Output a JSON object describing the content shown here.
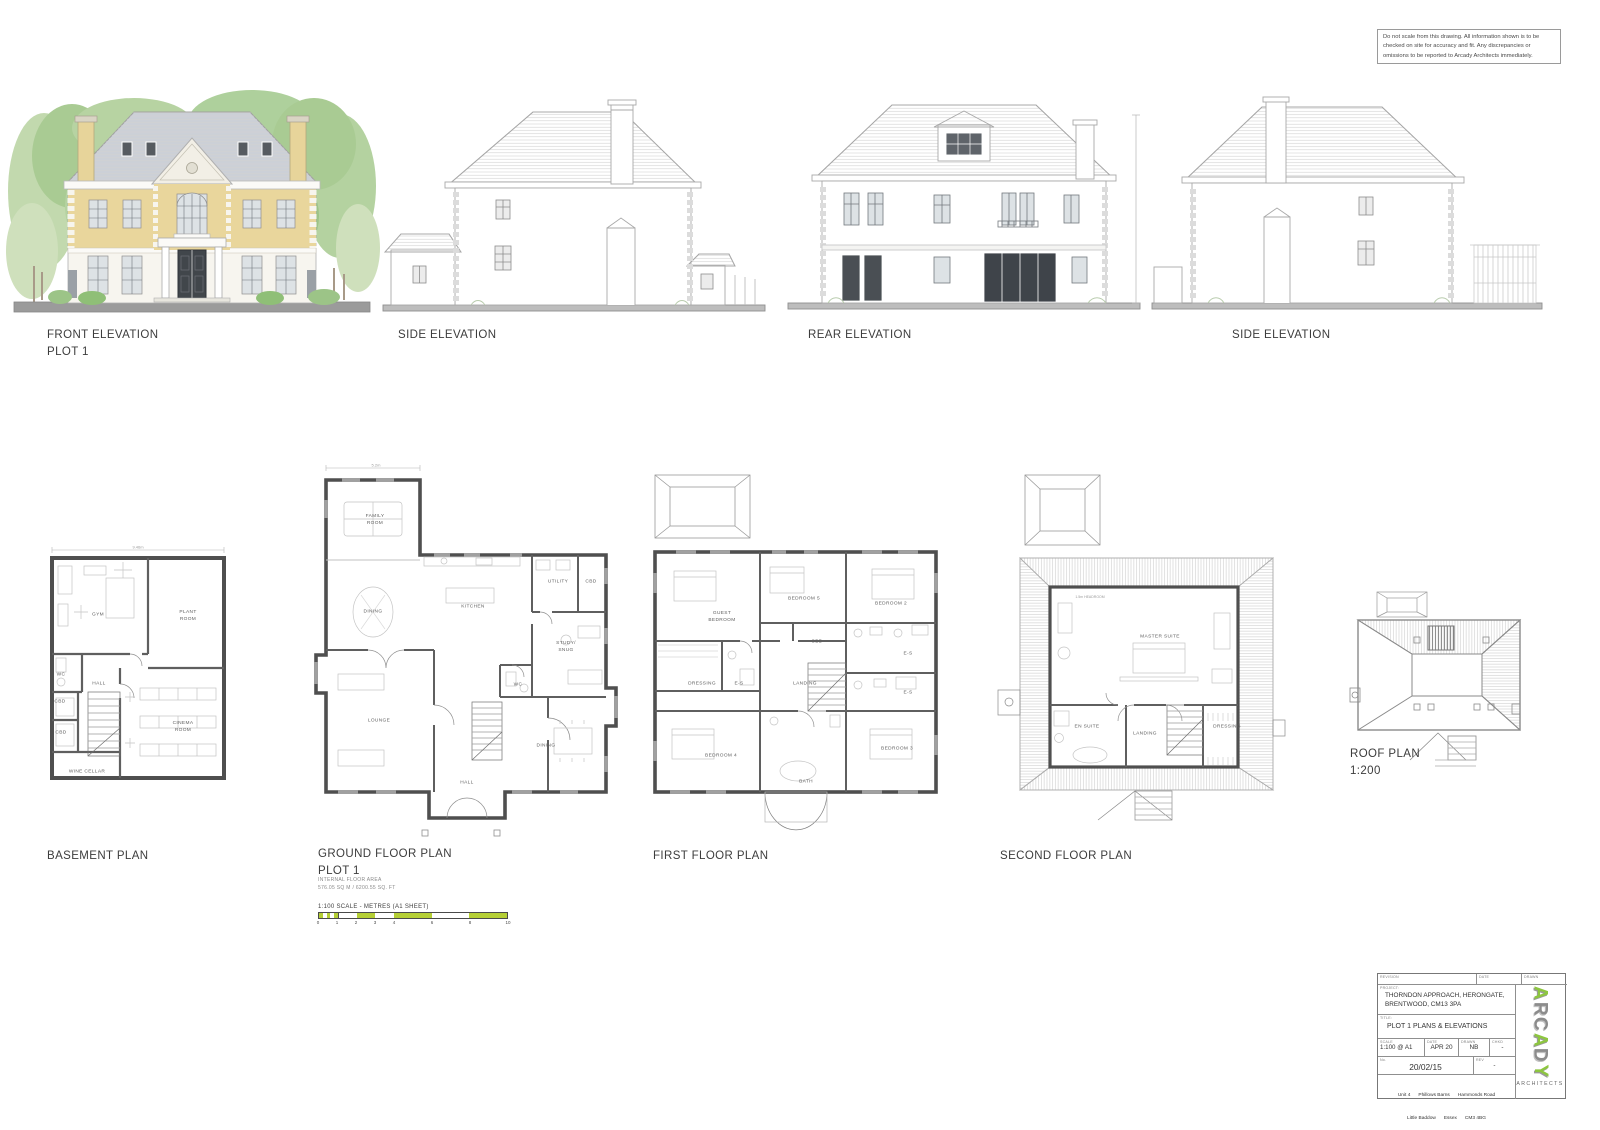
{
  "disclaimer": "Do not scale from this drawing. All information shown is to be checked on site for accuracy and fit. Any discrepancies or omissions to be reported to Arcady Architects immediately.",
  "elevations": {
    "front": {
      "title": "FRONT ELEVATION",
      "subtitle": "PLOT 1"
    },
    "side_left": {
      "title": "SIDE ELEVATION"
    },
    "rear": {
      "title": "REAR ELEVATION"
    },
    "side_right": {
      "title": "SIDE ELEVATION"
    }
  },
  "plans": {
    "basement": {
      "title": "BASEMENT PLAN",
      "top_dimension": "9.46m",
      "rooms": [
        "GYM",
        "PLANT ROOM",
        "WC",
        "HALL",
        "CBD",
        "CBD",
        "CINEMA ROOM",
        "WINE CELLAR"
      ]
    },
    "ground": {
      "title": "GROUND FLOOR PLAN",
      "subtitle": "PLOT 1",
      "area_label": "INTERNAL FLOOR AREA",
      "area_value": "576.05 SQ M / 6200.55 SQ. FT",
      "top_dimension": "5.2m",
      "rooms": [
        "FAMILY ROOM",
        "DINING",
        "KITCHEN",
        "UTILITY",
        "CBD",
        "STUDY/ SNUG",
        "WC",
        "LOUNGE",
        "HALL",
        "DINING"
      ]
    },
    "first": {
      "title": "FIRST FLOOR PLAN",
      "rooms": [
        "GUEST BEDROOM",
        "BEDROOM 5",
        "BEDROOM 2",
        "CBD",
        "DRESSING",
        "E-S",
        "LANDING",
        "E-S",
        "E-S",
        "BEDROOM 4",
        "BATH",
        "BEDROOM 3"
      ]
    },
    "second": {
      "title": "SECOND FLOOR PLAN",
      "headroom_note": "1.5m HEADROOM",
      "rooms": [
        "MASTER SUITE",
        "EN SUITE",
        "LANDING",
        "DRESSING"
      ]
    },
    "roof": {
      "title": "ROOF PLAN",
      "scale_note": "1:200"
    }
  },
  "scale_bar": {
    "label": "1:100 SCALE - METRES (A1 SHEET)",
    "ticks": [
      "0",
      "1",
      "2",
      "3",
      "4",
      "6",
      "8",
      "10"
    ],
    "bar_color": "#b5cf35"
  },
  "title_block": {
    "revision_header": "REVISION",
    "date_header": "DATE",
    "drawn_header": "DRAWN",
    "project_label": "PROJECT:",
    "project_line1": "THORNDON APPROACH, HERONGATE,",
    "project_line2": "BRENTWOOD, CM13 3PA",
    "title_label": "TITLE:",
    "title": "PLOT 1 PLANS & ELEVATIONS",
    "scale_label": "SCALE",
    "scale": "1:100 @ A1",
    "date_label": "DATE",
    "date": "APR 20",
    "drawn_label": "DRAWN",
    "drawn": "NB",
    "chkd_label": "CHKD",
    "chkd": "-",
    "no_label": "No.",
    "number": "20/02/15",
    "rev_label": "REV",
    "rev": "-",
    "address_line1": "Unit 4      Phillows Barns      Hammonds Road",
    "address_line2": "Little Baddow      Essex      CM3 4BG",
    "address_line3": "Tel. 01245 464681      www.arcadyarchitects.co.uk",
    "logo_letters": [
      "A",
      "R",
      "C",
      "A",
      "D",
      "Y"
    ],
    "architects_label": "ARCHITECTS",
    "logo_green": "#8dc63f",
    "logo_gray": "#8c8c8c"
  }
}
